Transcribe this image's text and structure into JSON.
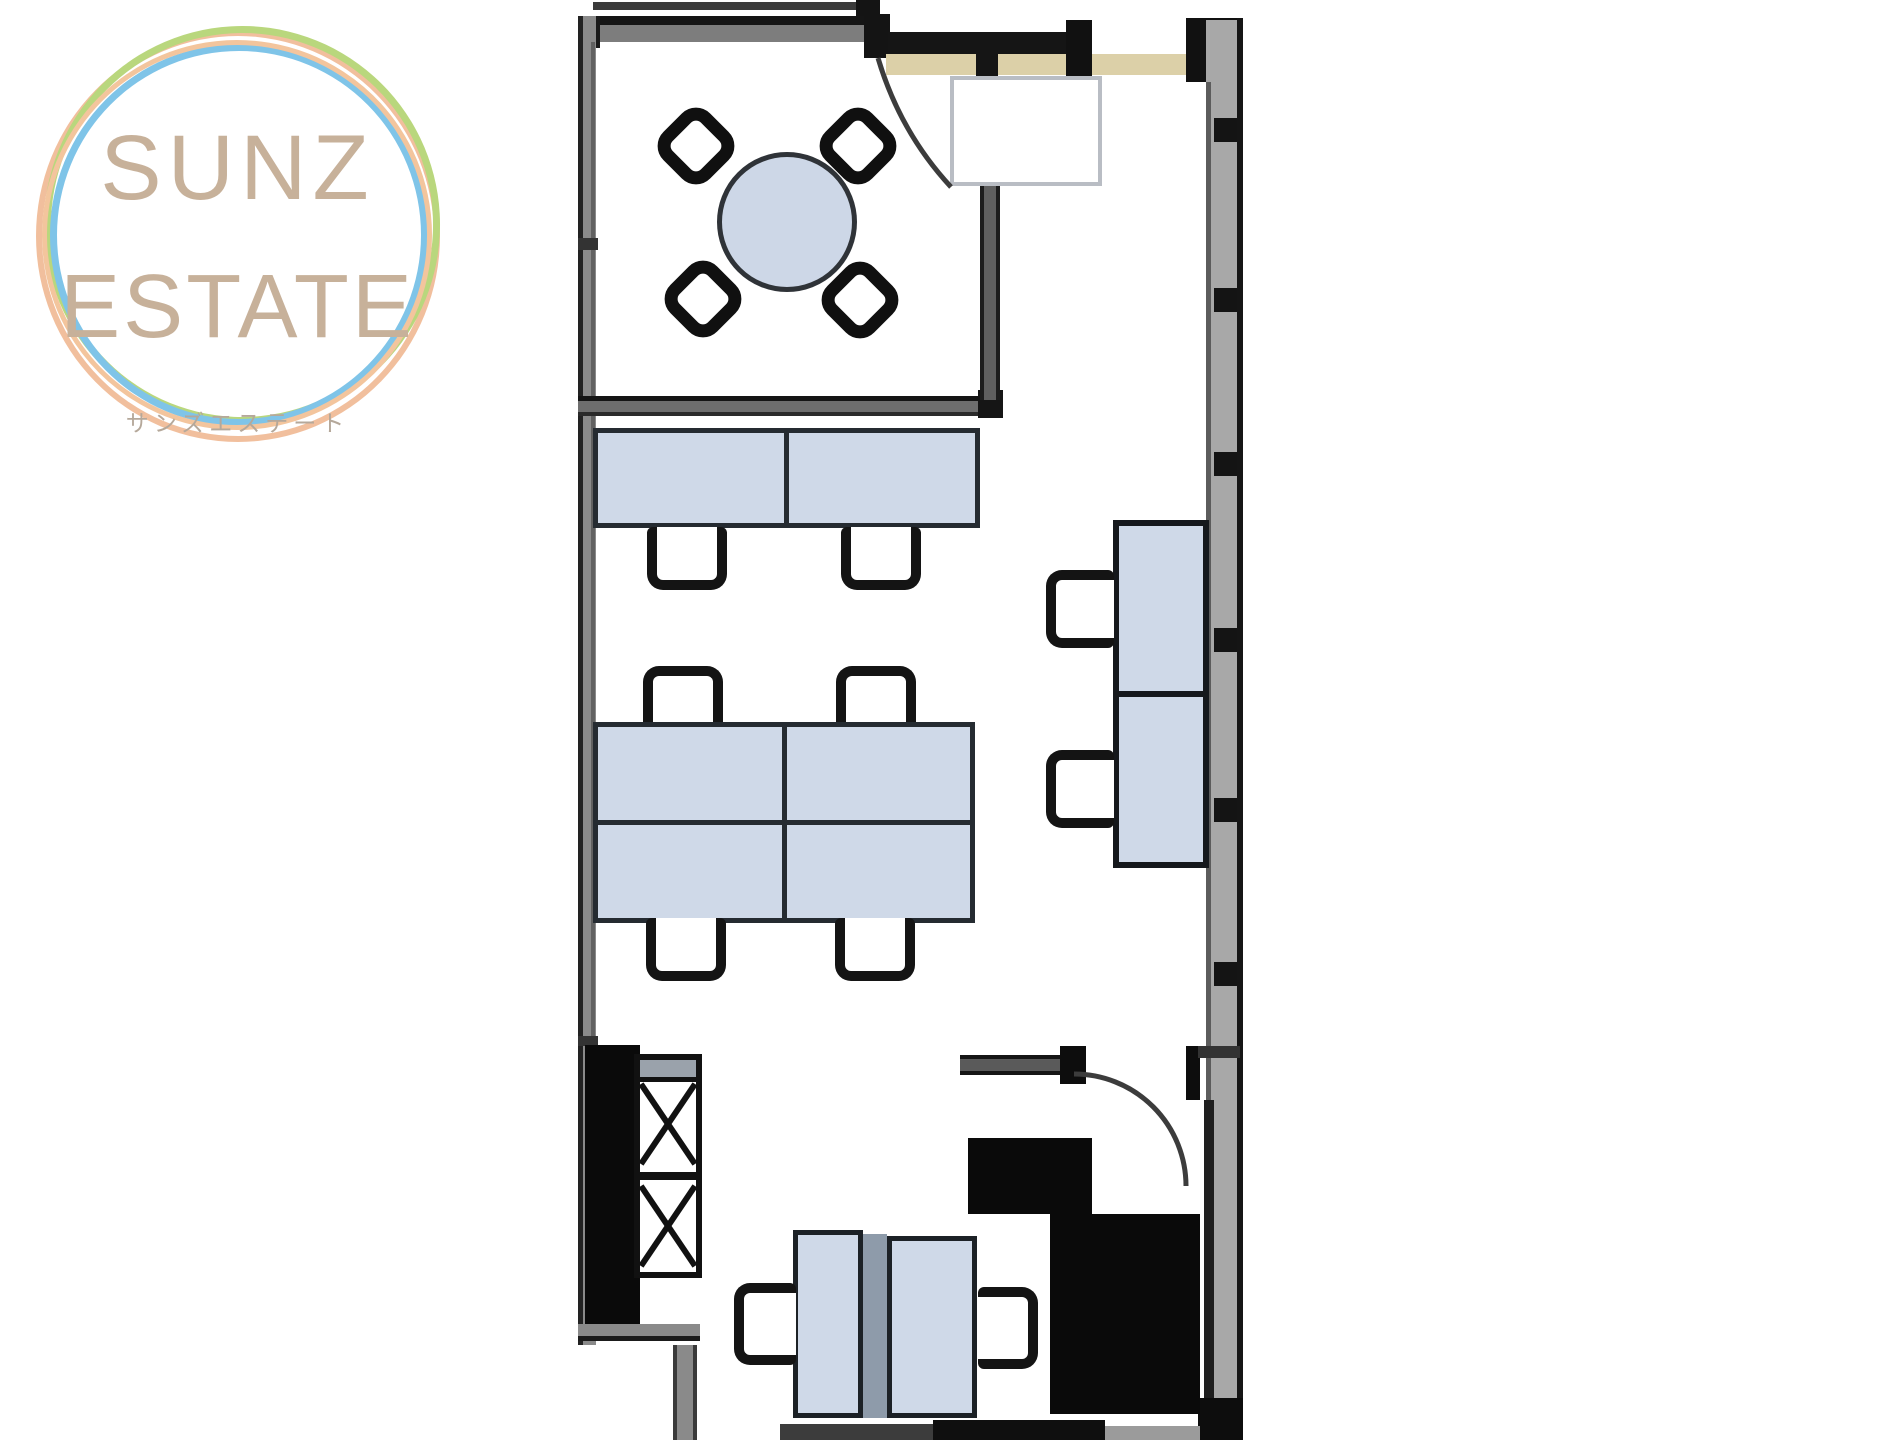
{
  "page": {
    "background": "#ffffff",
    "kind": "real-estate office floor plan image"
  },
  "logo": {
    "line1": "SUNZ",
    "line2": "ESTATE",
    "subtitle": "サンズエステート",
    "text_color": "#c7b19a",
    "subtitle_color": "#b5a89a",
    "ring_green": "#b9d77d",
    "ring_blue": "#7fc4e8",
    "ring_orange": "#efb892"
  },
  "floorplan": {
    "wall_gray": "#8a8a8a",
    "wall_black": "#141414",
    "entry_beige": "#dcd0a8",
    "furniture_fill": "#cfd9e8",
    "furniture_border": "#252b31",
    "elements": [
      "meeting-room-round-table-4-chairs",
      "entrance-door-leaf",
      "desk-pair-2-chairs",
      "desk-cluster-2x2-4-chairs",
      "window-side-desk-column-2-chairs",
      "x-hatched-storage-cabinet",
      "bottom-desk-pair-2-chairs",
      "service-core-black-blocks",
      "door-swing-arc"
    ]
  }
}
